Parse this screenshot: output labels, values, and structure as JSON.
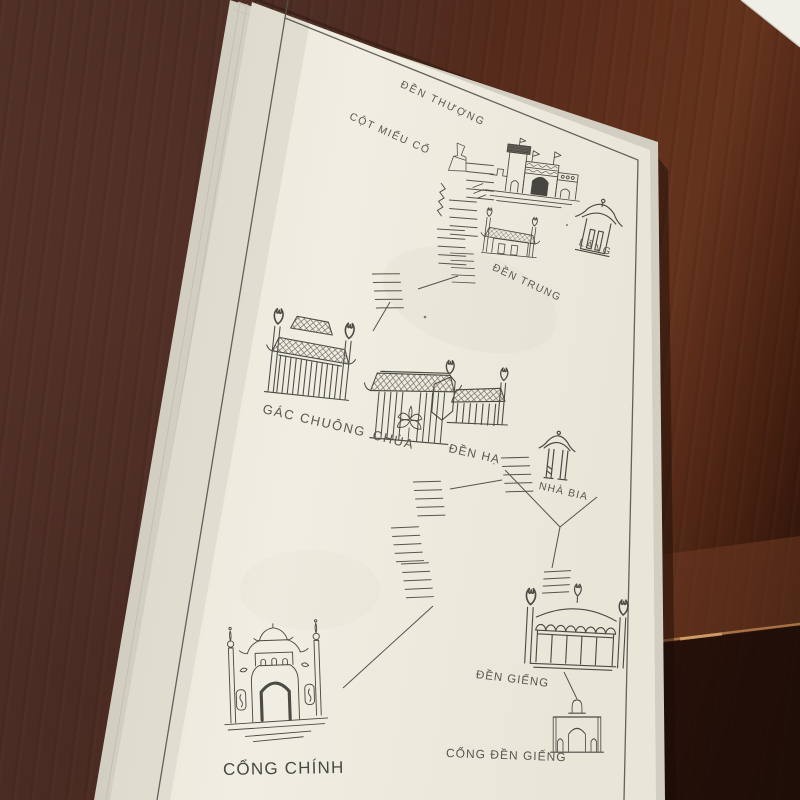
{
  "map": {
    "sites": [
      {
        "id": "den-thuong",
        "label": "ĐỀN THƯỢNG",
        "icon": "upper-temple-icon"
      },
      {
        "id": "cot-mieu-co",
        "label": "CỘT MIẾU CỔ",
        "icon": "ancient-shrine-column-icon"
      },
      {
        "id": "lang",
        "label": "LĂNG",
        "icon": "tomb-pavilion-icon"
      },
      {
        "id": "den-trung",
        "label": "ĐỀN TRUNG",
        "icon": "middle-temple-icon"
      },
      {
        "id": "gac-chuong",
        "label": "GÁC CHUÔNG",
        "icon": "bell-tower-icon"
      },
      {
        "id": "chua",
        "label": "CHÙA",
        "icon": "pagoda-icon"
      },
      {
        "id": "den-ha",
        "label": "ĐỀN HẠ",
        "icon": "lower-temple-icon"
      },
      {
        "id": "nha-bia",
        "label": "NHÀ BIA",
        "icon": "stele-house-icon"
      },
      {
        "id": "den-gieng",
        "label": "ĐỀN GIẾNG",
        "icon": "well-temple-icon"
      },
      {
        "id": "cong-den-gieng",
        "label": "CỔNG ĐỀN GIẾNG",
        "icon": "well-temple-gate-icon"
      },
      {
        "id": "cong-chinh",
        "label": "CỔNG CHÍNH",
        "icon": "main-gate-icon"
      }
    ],
    "connections": [
      {
        "from": "ĐỀN THƯỢNG",
        "to": "ĐỀN TRUNG",
        "type": "steps"
      },
      {
        "from": "ĐỀN TRUNG",
        "to": "CHÙA",
        "type": "steps"
      },
      {
        "from": "ĐỀN HẠ",
        "to": "NHÀ BIA",
        "type": "path"
      },
      {
        "from": "ĐỀN HẠ",
        "to": "CỔNG CHÍNH",
        "type": "steps"
      },
      {
        "from": "NHÀ BIA",
        "to": "ĐỀN GIẾNG",
        "type": "steps"
      },
      {
        "from": "ĐỀN GIẾNG",
        "to": "CỔNG ĐỀN GIẾNG",
        "type": "path"
      }
    ]
  },
  "colors": {
    "wood_dark": "#4a2b23",
    "wood_red": "#5f2f1b",
    "wood_shadow": "#27100a",
    "page": "#edeadd",
    "page_edge": "#d2cfc2",
    "ink": "#4c4a44",
    "label_text": "#5a5750"
  }
}
